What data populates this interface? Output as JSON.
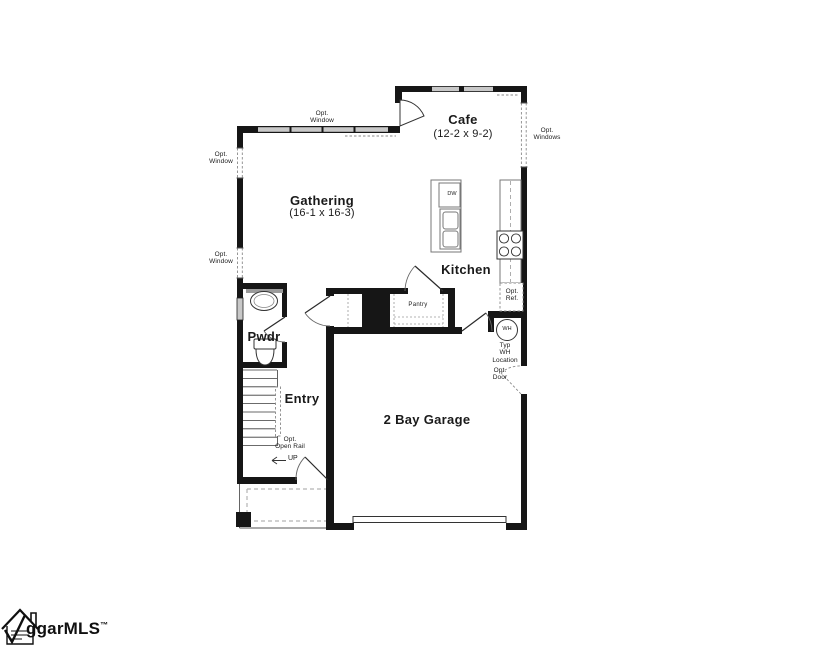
{
  "colors": {
    "wall": "#161616",
    "window": "#c8c8c8",
    "line": "#777777",
    "dash": "#8a8a8a",
    "porch": "#b5b5b5",
    "text": "#1a1a1a"
  },
  "rooms": {
    "gathering": {
      "name": "Gathering",
      "dims": "(16-1 x 16-3)"
    },
    "cafe": {
      "name": "Cafe",
      "dims": "(12-2 x 9-2)"
    },
    "kitchen": {
      "name": "Kitchen"
    },
    "pwdr": {
      "name": "Pwdr"
    },
    "entry": {
      "name": "Entry"
    },
    "garage": {
      "name": "2 Bay Garage"
    },
    "pantry": {
      "name": "Pantry"
    }
  },
  "annotations": {
    "opt_window": "Opt.\nWindow",
    "opt_windows": "Opt.\nWindows",
    "opt_ref": "Opt.\nRef.",
    "opt_door": "Opt.\nDoor",
    "opt_open_rail": "Opt.\nOpen Rail",
    "typ_wh_location": "Typ\nWH\nLocation",
    "wh": "WH",
    "dw": "DW",
    "up": "UP"
  },
  "logo": {
    "text": "ggarMLS",
    "tm": "™"
  }
}
